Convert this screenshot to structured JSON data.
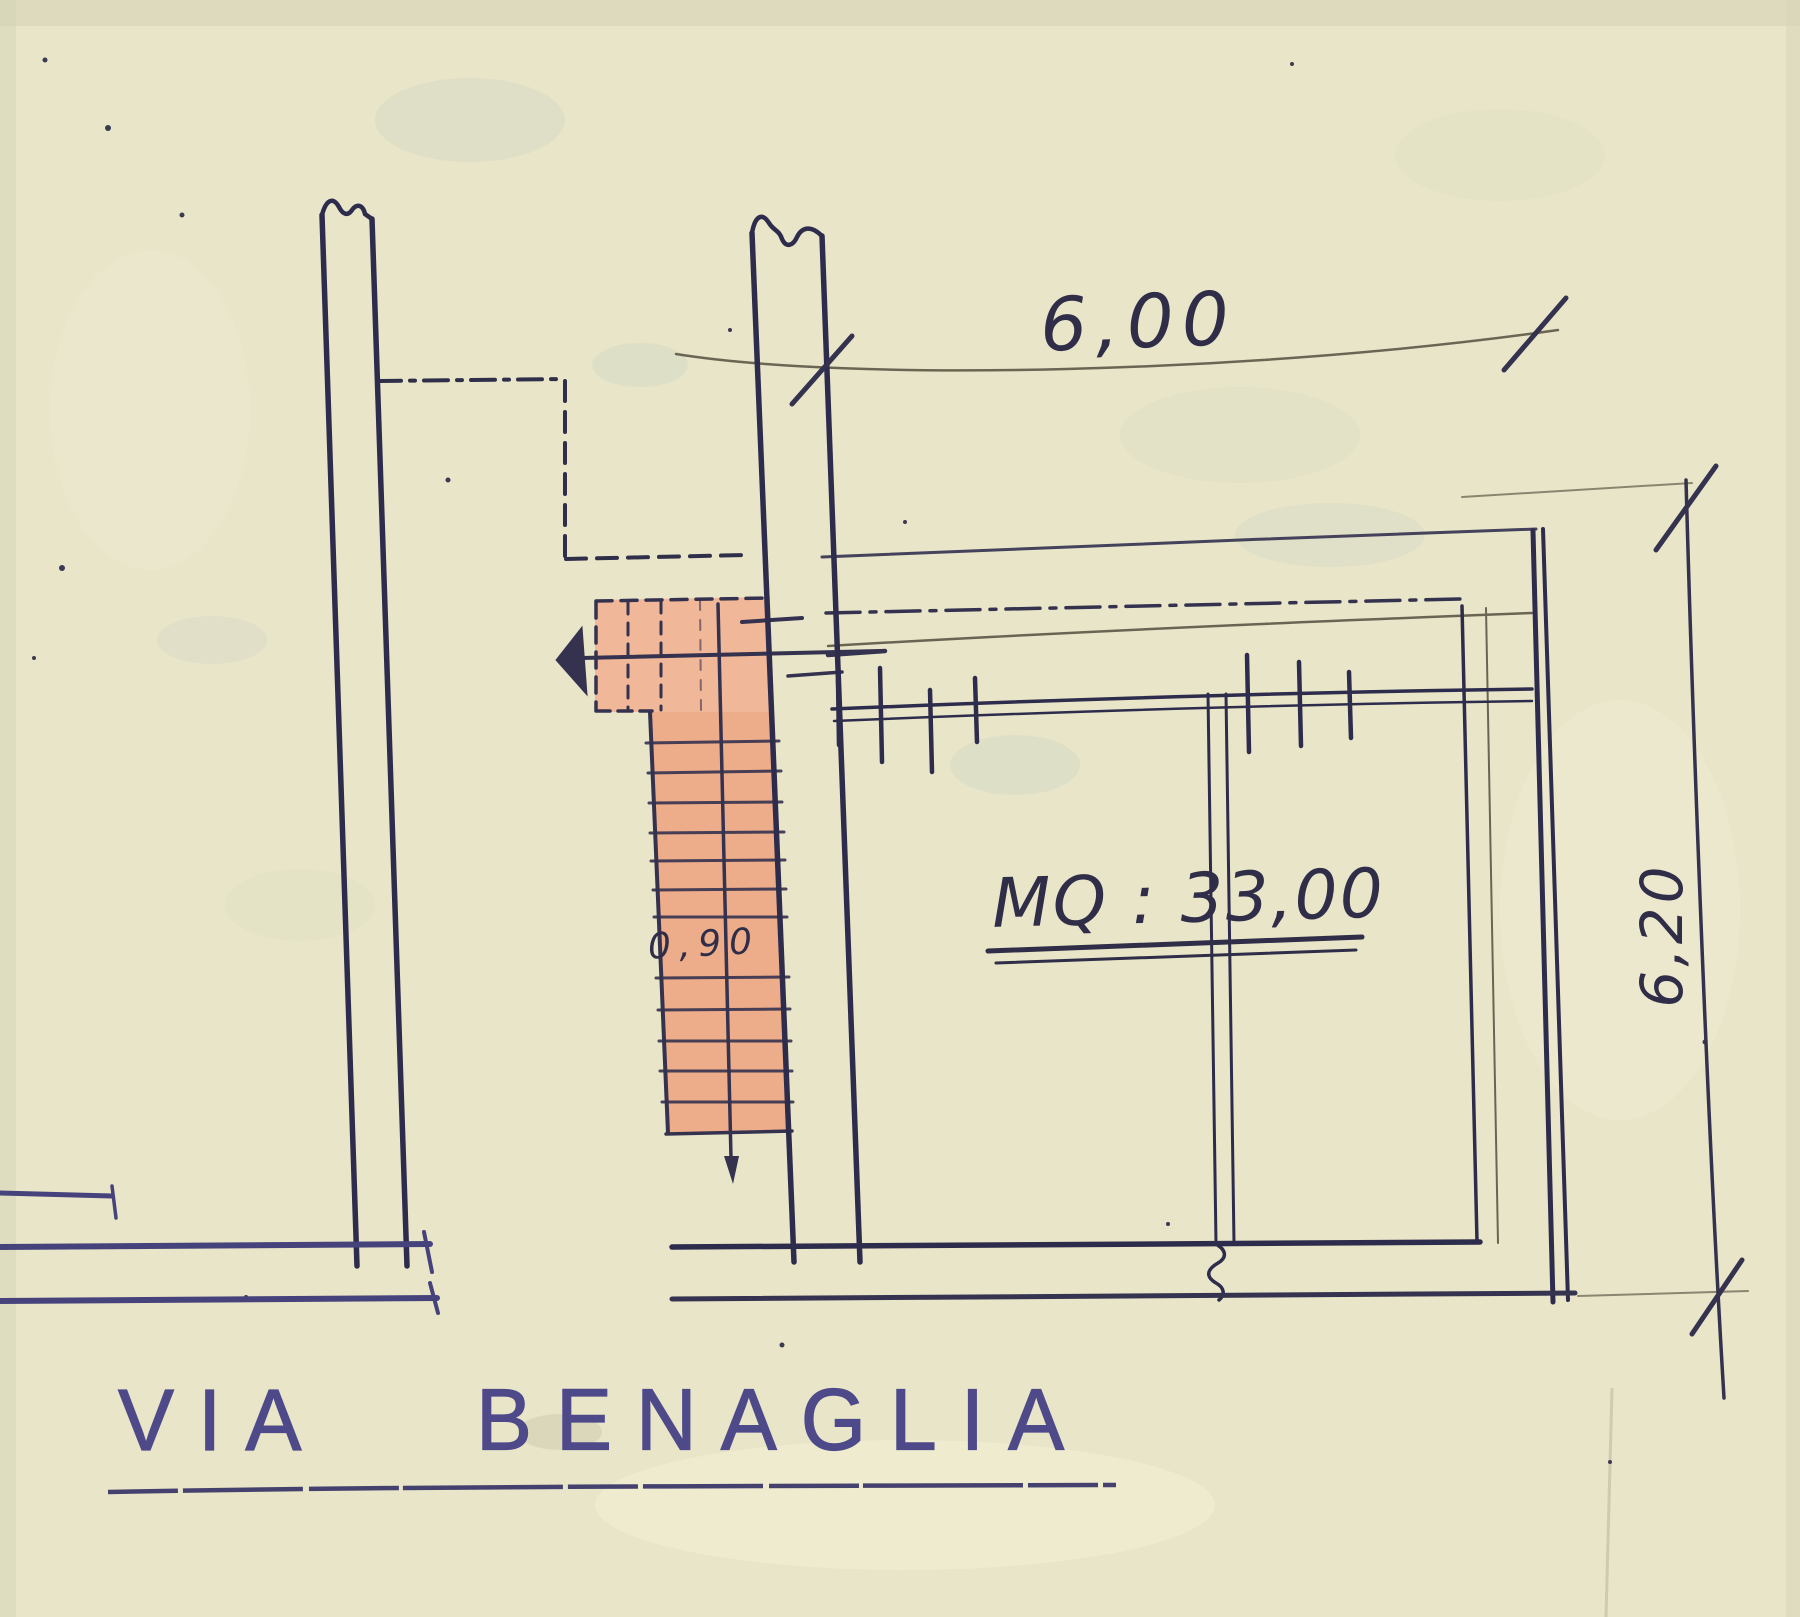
{
  "plan": {
    "dimensions": {
      "top_width_label": "6,00",
      "right_height_label": "6,20"
    },
    "area_label": "MQ : 33,00",
    "stair_width_label": "0,90",
    "street_name": {
      "word1": "VIA",
      "word2": "BENAGLIA"
    }
  },
  "colors": {
    "paper": "#e9e5c8",
    "wall_ink": "#2e2c4c",
    "street_ink": "#46437c",
    "pencil": "#6a6553",
    "stair_fill": "#eeae8c",
    "street_text": "#4e4a8a"
  }
}
